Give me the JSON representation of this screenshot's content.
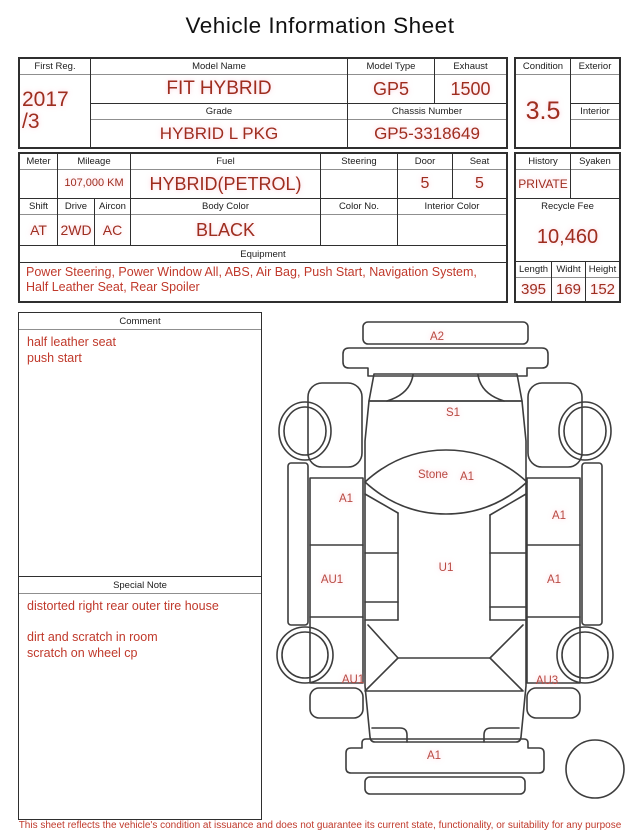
{
  "title": "Vehicle Information Sheet",
  "fields": {
    "first_reg": {
      "label": "First Reg.",
      "value": [
        "2017",
        "/3"
      ]
    },
    "model_name": {
      "label": "Model Name",
      "value": "FIT HYBRID"
    },
    "model_type": {
      "label": "Model Type",
      "value": "GP5"
    },
    "exhaust": {
      "label": "Exhaust",
      "value": "1500"
    },
    "grade": {
      "label": "Grade",
      "value": "HYBRID L PKG"
    },
    "chassis_number": {
      "label": "Chassis Number",
      "value": "GP5-3318649"
    },
    "condition": {
      "label": "Condition",
      "value": "3.5"
    },
    "exterior": {
      "label": "Exterior",
      "value": ""
    },
    "interior": {
      "label": "Interior",
      "value": ""
    },
    "meter": {
      "label": "Meter",
      "value": ""
    },
    "mileage": {
      "label": "Mileage",
      "value": "107,000 KM"
    },
    "fuel": {
      "label": "Fuel",
      "value": "HYBRID(PETROL)"
    },
    "steering": {
      "label": "Steering",
      "value": ""
    },
    "door": {
      "label": "Door",
      "value": "5"
    },
    "seat": {
      "label": "Seat",
      "value": "5"
    },
    "shift": {
      "label": "Shift",
      "value": "AT"
    },
    "drive": {
      "label": "Drive",
      "value": "2WD"
    },
    "aircon": {
      "label": "Aircon",
      "value": "AC"
    },
    "body_color": {
      "label": "Body Color",
      "value": "BLACK"
    },
    "color_no": {
      "label": "Color No.",
      "value": ""
    },
    "interior_color": {
      "label": "Interior Color",
      "value": ""
    },
    "equipment": {
      "label": "Equipment",
      "value": "Power Steering, Power Window  All, ABS, Air Bag, Push Start, Navigation System, Half Leather Seat, Rear Spoiler"
    },
    "history": {
      "label": "History",
      "value": "PRIVATE"
    },
    "syaken": {
      "label": "Syaken",
      "value": ""
    },
    "recycle_fee": {
      "label": "Recycle Fee",
      "value": "10,460"
    },
    "length": {
      "label": "Length",
      "value": "395"
    },
    "width": {
      "label": "Widht",
      "value": "169"
    },
    "height": {
      "label": "Height",
      "value": "152"
    }
  },
  "comment": {
    "label": "Comment",
    "text": [
      "half leather seat",
      "push start"
    ]
  },
  "special_note": {
    "label": "Special Note",
    "text": [
      "distorted right rear outer tire house",
      "",
      "dirt and scratch in room",
      "scratch on wheel cp"
    ]
  },
  "diagram": {
    "labels": [
      {
        "part": "rear-spoiler",
        "text": "A2"
      },
      {
        "part": "roof",
        "text": "S1"
      },
      {
        "part": "glass-stone",
        "text": "Stone"
      },
      {
        "part": "glass-grade",
        "text": "A1"
      },
      {
        "part": "left-front-door",
        "text": "A1"
      },
      {
        "part": "right-front-door",
        "text": "A1"
      },
      {
        "part": "left-rear-door",
        "text": "AU1"
      },
      {
        "part": "right-rear-door",
        "text": "A1"
      },
      {
        "part": "floor",
        "text": "U1"
      },
      {
        "part": "left-rear-quarter",
        "text": "AU1"
      },
      {
        "part": "right-rear-quarter",
        "text": "AU3"
      },
      {
        "part": "front-bumper",
        "text": "A1"
      }
    ]
  },
  "footer": "This sheet reflects the vehicle's condition at issuance and does not guarantee its current state, functionality, or suitability for any purpose",
  "colors": {
    "value_red": "#9e2d1f",
    "note_red": "#c0392b",
    "diagram_label_red": "#b94a42",
    "border": "#2f2f2f"
  }
}
